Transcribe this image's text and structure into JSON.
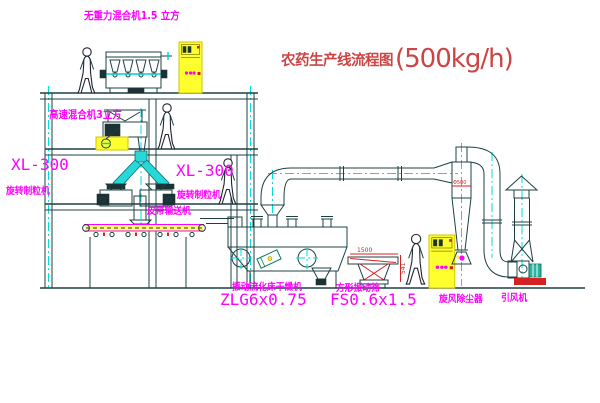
{
  "title": {
    "text": "农药生产线流程图",
    "capacity": "(500kg/h)"
  },
  "labels": {
    "gravity_mixer": "无重力混合机1.5 立方",
    "high_speed_mixer": "高速混合机3立方",
    "granulator_left_model": "XL-300",
    "granulator_left_name": "旋转制粒机",
    "granulator_right_model": "XL-300",
    "granulator_right_name": "旋转制粒机",
    "belt_conveyor": "皮带输送机",
    "dryer_name": "振动流化床干燥机",
    "dryer_model": "ZLG6x0.75",
    "screen_name": "方形振动筛",
    "screen_model": "FS0.6x1.5",
    "cyclone_name": "旋风除尘器",
    "fan_name": "引风机"
  },
  "dimensions": {
    "screen_length": "1500",
    "screen_height": "541",
    "cyclone_dia": "Φ500"
  },
  "colors": {
    "label_magenta": "#ff00ff",
    "title_red": "#cc4545",
    "line_dark_teal": "#1c4042",
    "centerline_cyan": "#00dede",
    "cabinet_yellow": "#ffff2e"
  }
}
